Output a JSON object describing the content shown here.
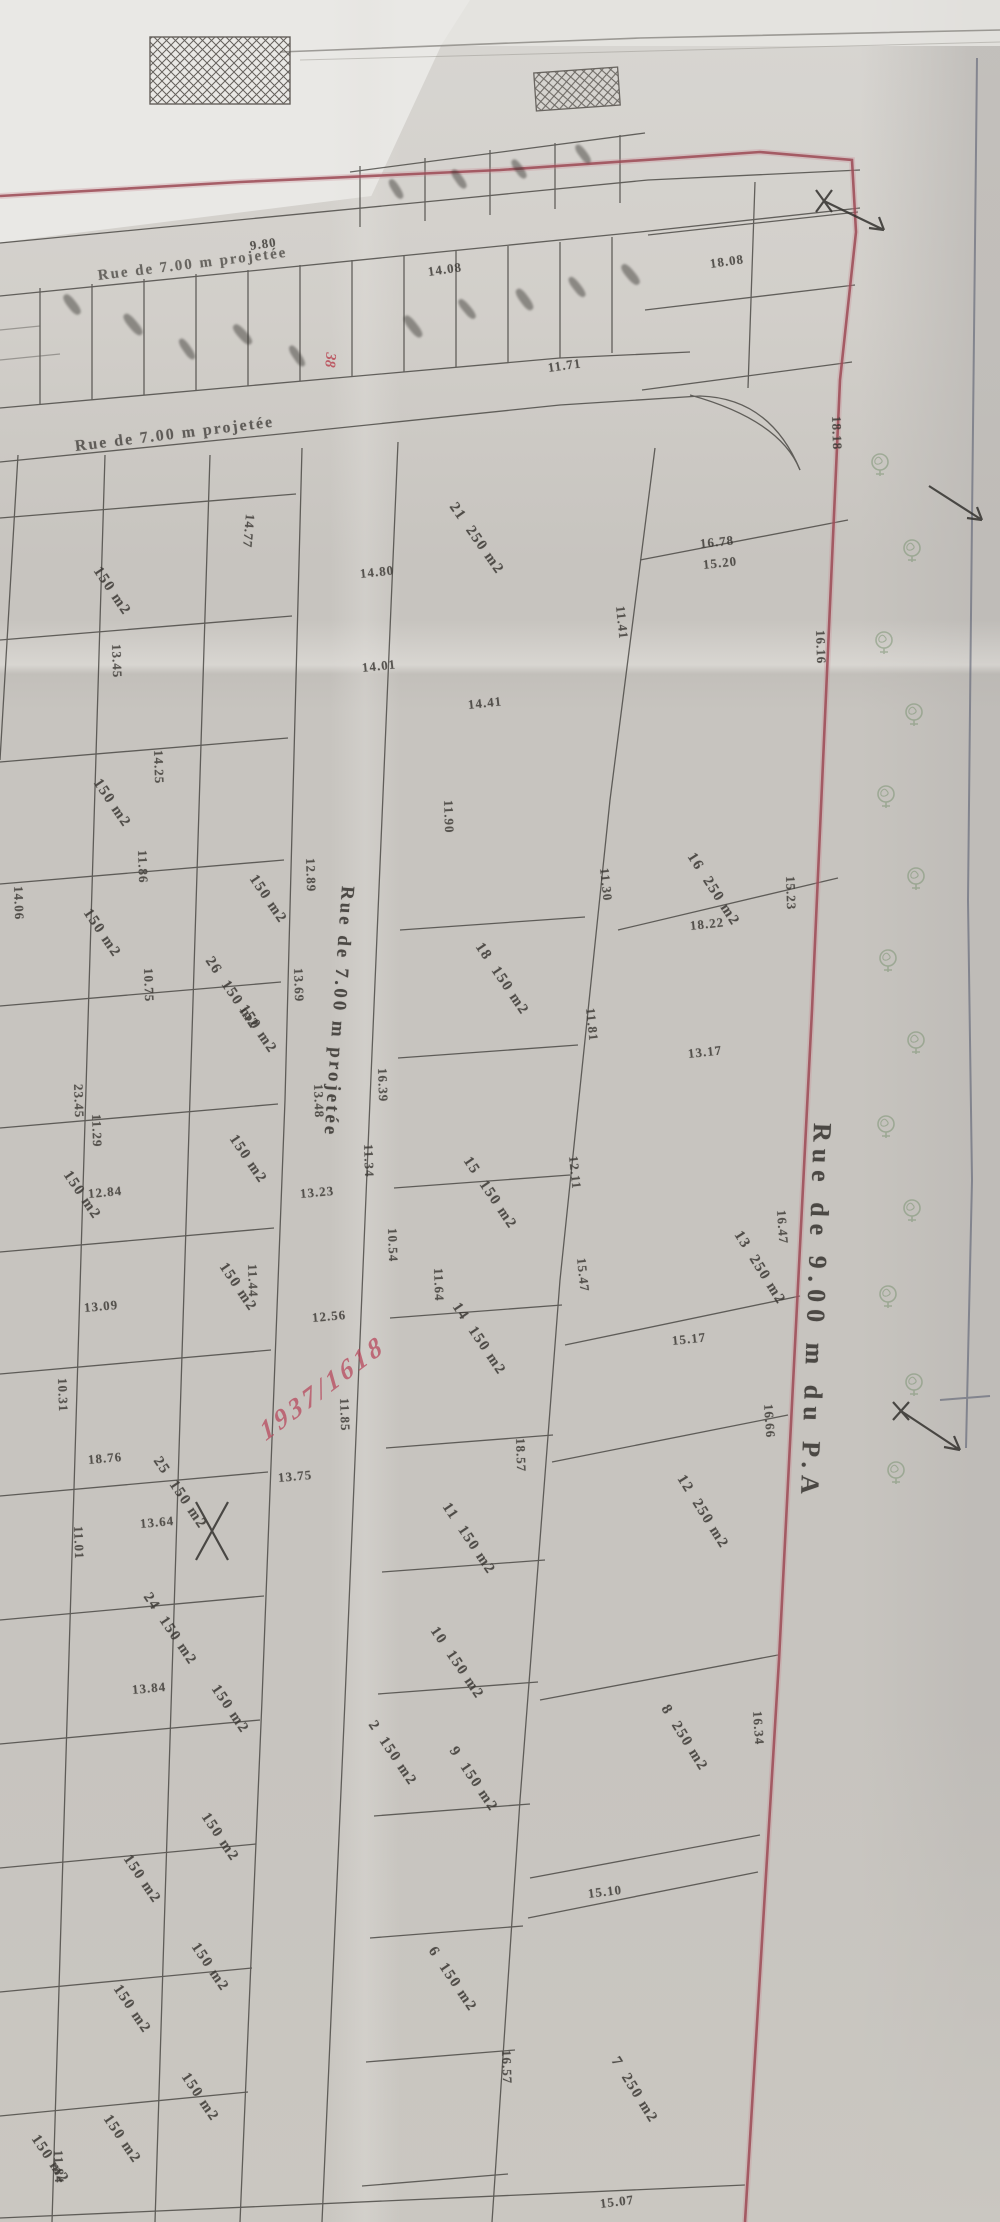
{
  "map_type": "cadastral subdivision plan (photo, rotated)",
  "streets": {
    "right": {
      "label": "Rue de 9.00 m du P.A"
    },
    "middle": {
      "label": "Rue de 7.00 m projetée"
    },
    "top": {
      "label": "Rue de 7.00 m projetée"
    },
    "diagonal": {
      "label": "Rue de 7.00 m projetée"
    }
  },
  "annotations": {
    "red_handwriting": "1937/1618",
    "red_parcel_number": "38"
  },
  "colors": {
    "red_line": "#9c4a55",
    "red_text": "#b84a5e",
    "tree_green": "#76906d",
    "ink": "#33312e",
    "blue_edge": "#5a5f72",
    "paper": "#c7c4bf"
  },
  "parcels": [
    {
      "n": "21",
      "a": "250 m2",
      "x": 452,
      "y": 496,
      "r": 55
    },
    {
      "n": "16",
      "a": "250 m2",
      "x": 690,
      "y": 846,
      "r": 57
    },
    {
      "n": "13",
      "a": "250 m2",
      "x": 737,
      "y": 1224,
      "r": 58
    },
    {
      "n": "12",
      "a": "250 m2",
      "x": 680,
      "y": 1468,
      "r": 58
    },
    {
      "n": "8",
      "a": "250 m2",
      "x": 664,
      "y": 1698,
      "r": 58
    },
    {
      "n": "7",
      "a": "250 m2",
      "x": 614,
      "y": 2050,
      "r": 58
    },
    {
      "n": "18",
      "a": "150 m2",
      "x": 478,
      "y": 936,
      "r": 56
    },
    {
      "n": "15",
      "a": "150 m2",
      "x": 466,
      "y": 1150,
      "r": 56
    },
    {
      "n": "14",
      "a": "150 m2",
      "x": 455,
      "y": 1296,
      "r": 56
    },
    {
      "n": "11",
      "a": "150 m2",
      "x": 445,
      "y": 1496,
      "r": 56
    },
    {
      "n": "10",
      "a": "150 m2",
      "x": 433,
      "y": 1620,
      "r": 56
    },
    {
      "n": "9",
      "a": "150 m2",
      "x": 452,
      "y": 1740,
      "r": 56
    },
    {
      "n": "6",
      "a": "150 m2",
      "x": 431,
      "y": 1940,
      "r": 56
    },
    {
      "n": "2",
      "a": "150 m2",
      "x": 371,
      "y": 1714,
      "r": 56
    },
    {
      "n": "26",
      "a": "150 m2",
      "x": 208,
      "y": 950,
      "r": 56
    },
    {
      "n": "25",
      "a": "150 m2",
      "x": 156,
      "y": 1450,
      "r": 56
    },
    {
      "n": "24",
      "a": "150 m2",
      "x": 146,
      "y": 1586,
      "r": 56
    },
    {
      "n": "",
      "a": "150 m2",
      "x": 252,
      "y": 868,
      "r": 56
    },
    {
      "n": "",
      "a": "150 m2",
      "x": 242,
      "y": 998,
      "r": 56
    },
    {
      "n": "",
      "a": "150 m2",
      "x": 232,
      "y": 1128,
      "r": 56
    },
    {
      "n": "",
      "a": "150 m2",
      "x": 222,
      "y": 1256,
      "r": 56
    },
    {
      "n": "",
      "a": "150 m2",
      "x": 214,
      "y": 1678,
      "r": 56
    },
    {
      "n": "",
      "a": "150 m2",
      "x": 204,
      "y": 1806,
      "r": 56
    },
    {
      "n": "",
      "a": "150 m2",
      "x": 194,
      "y": 1936,
      "r": 56
    },
    {
      "n": "",
      "a": "150 m2",
      "x": 184,
      "y": 2066,
      "r": 56
    },
    {
      "n": "",
      "a": "150 m2",
      "x": 96,
      "y": 772,
      "r": 56
    },
    {
      "n": "",
      "a": "150 m2",
      "x": 86,
      "y": 902,
      "r": 56
    },
    {
      "n": "",
      "a": "150 m2",
      "x": 66,
      "y": 1164,
      "r": 56
    },
    {
      "n": "",
      "a": "150 m2",
      "x": 126,
      "y": 1848,
      "r": 56
    },
    {
      "n": "",
      "a": "150 m2",
      "x": 116,
      "y": 1978,
      "r": 56
    },
    {
      "n": "",
      "a": "150 m2",
      "x": 106,
      "y": 2108,
      "r": 56
    },
    {
      "n": "",
      "a": "150 m2",
      "x": 96,
      "y": 560,
      "r": 56
    },
    {
      "n": "",
      "a": "150 m2",
      "x": 34,
      "y": 2128,
      "r": 56
    }
  ],
  "dims": [
    {
      "v": "15.07",
      "x": 600,
      "y": 2196,
      "r": -7
    },
    {
      "v": "15.10",
      "x": 588,
      "y": 1886,
      "r": -7
    },
    {
      "v": "16.57",
      "x": 506,
      "y": 2042,
      "r": 88
    },
    {
      "v": "16.34",
      "x": 757,
      "y": 1703,
      "r": 86
    },
    {
      "v": "16.66",
      "x": 768,
      "y": 1396,
      "r": 86
    },
    {
      "v": "16.47",
      "x": 781,
      "y": 1202,
      "r": 86
    },
    {
      "v": "18.57",
      "x": 520,
      "y": 1430,
      "r": 88
    },
    {
      "v": "15.17",
      "x": 672,
      "y": 1333,
      "r": -6
    },
    {
      "v": "18.22",
      "x": 690,
      "y": 918,
      "r": -6
    },
    {
      "v": "13.17",
      "x": 688,
      "y": 1046,
      "r": -6
    },
    {
      "v": "12.11",
      "x": 573,
      "y": 1148,
      "r": 84
    },
    {
      "v": "11.81",
      "x": 590,
      "y": 1000,
      "r": 84
    },
    {
      "v": "11.30",
      "x": 604,
      "y": 860,
      "r": 84
    },
    {
      "v": "15.47",
      "x": 581,
      "y": 1250,
      "r": 84
    },
    {
      "v": "11.41",
      "x": 620,
      "y": 598,
      "r": 84
    },
    {
      "v": "16.16",
      "x": 820,
      "y": 622,
      "r": 88
    },
    {
      "v": "18.18",
      "x": 836,
      "y": 408,
      "r": 88
    },
    {
      "v": "15.23",
      "x": 790,
      "y": 868,
      "r": 88
    },
    {
      "v": "16.78",
      "x": 700,
      "y": 536,
      "r": -6
    },
    {
      "v": "15.20",
      "x": 703,
      "y": 557,
      "r": -6
    },
    {
      "v": "14.80",
      "x": 360,
      "y": 566,
      "r": -6
    },
    {
      "v": "14.77",
      "x": 250,
      "y": 506,
      "r": 95
    },
    {
      "v": "14.41",
      "x": 468,
      "y": 697,
      "r": -6
    },
    {
      "v": "11.90",
      "x": 448,
      "y": 792,
      "r": 88
    },
    {
      "v": "14.01",
      "x": 362,
      "y": 660,
      "r": -6
    },
    {
      "v": "12.89",
      "x": 310,
      "y": 850,
      "r": 88
    },
    {
      "v": "13.69",
      "x": 298,
      "y": 960,
      "r": 88
    },
    {
      "v": "13.48",
      "x": 318,
      "y": 1076,
      "r": 88
    },
    {
      "v": "16.39",
      "x": 382,
      "y": 1060,
      "r": 88
    },
    {
      "v": "11.34",
      "x": 368,
      "y": 1136,
      "r": 88
    },
    {
      "v": "13.23",
      "x": 300,
      "y": 1186,
      "r": -5
    },
    {
      "v": "11.44",
      "x": 252,
      "y": 1256,
      "r": 88
    },
    {
      "v": "12.56",
      "x": 312,
      "y": 1310,
      "r": -5
    },
    {
      "v": "10.54",
      "x": 392,
      "y": 1220,
      "r": 88
    },
    {
      "v": "11.64",
      "x": 438,
      "y": 1260,
      "r": 88
    },
    {
      "v": "11.85",
      "x": 344,
      "y": 1390,
      "r": 88
    },
    {
      "v": "13.75",
      "x": 278,
      "y": 1470,
      "r": -5
    },
    {
      "v": "13.64",
      "x": 140,
      "y": 1516,
      "r": -5
    },
    {
      "v": "13.84",
      "x": 132,
      "y": 1682,
      "r": -5
    },
    {
      "v": "10.31",
      "x": 62,
      "y": 1370,
      "r": 88
    },
    {
      "v": "11.01",
      "x": 78,
      "y": 1518,
      "r": 88
    },
    {
      "v": "14.25",
      "x": 158,
      "y": 742,
      "r": 88
    },
    {
      "v": "11.86",
      "x": 142,
      "y": 842,
      "r": 88
    },
    {
      "v": "10.75",
      "x": 148,
      "y": 960,
      "r": 88
    },
    {
      "v": "23.45",
      "x": 78,
      "y": 1076,
      "r": 88
    },
    {
      "v": "12.84",
      "x": 88,
      "y": 1186,
      "r": -5
    },
    {
      "v": "13.09",
      "x": 84,
      "y": 1300,
      "r": -5
    },
    {
      "v": "18.76",
      "x": 88,
      "y": 1452,
      "r": -5
    },
    {
      "v": "14.06",
      "x": 18,
      "y": 878,
      "r": 88
    },
    {
      "v": "13.45",
      "x": 116,
      "y": 636,
      "r": 88
    },
    {
      "v": "11.29",
      "x": 96,
      "y": 1106,
      "r": 88
    },
    {
      "v": "11.71",
      "x": 548,
      "y": 360,
      "r": -8
    },
    {
      "v": "14.08",
      "x": 428,
      "y": 264,
      "r": -8
    },
    {
      "v": "18.08",
      "x": 710,
      "y": 256,
      "r": -8
    },
    {
      "v": "9.80",
      "x": 250,
      "y": 238,
      "r": -8
    },
    {
      "v": "11.84",
      "x": 58,
      "y": 2142,
      "r": 88
    }
  ],
  "trees": [
    [
      880,
      462
    ],
    [
      912,
      548
    ],
    [
      884,
      640
    ],
    [
      914,
      712
    ],
    [
      886,
      794
    ],
    [
      916,
      876
    ],
    [
      888,
      958
    ],
    [
      916,
      1040
    ],
    [
      886,
      1124
    ],
    [
      912,
      1208
    ],
    [
      888,
      1294
    ],
    [
      914,
      1382
    ],
    [
      896,
      1470
    ]
  ]
}
